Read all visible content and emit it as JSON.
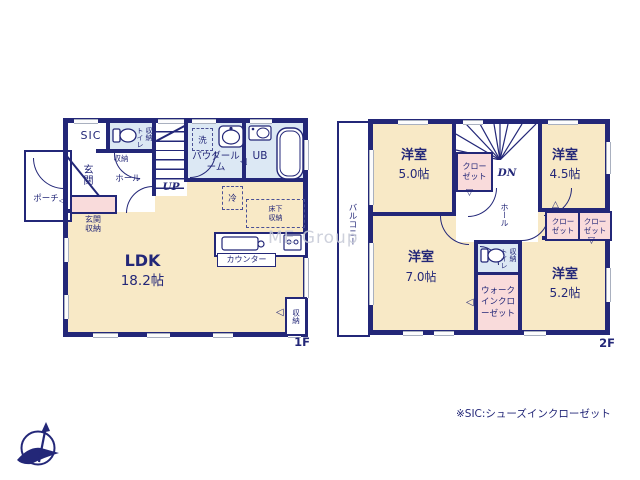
{
  "watermark": "ME Group",
  "footnote": "※SIC:シューズインクローゼット",
  "colors": {
    "wall": "#232778",
    "room_cream": "#f8e9c6",
    "room_blue": "#dce8f4",
    "room_pink": "#f9dbdb",
    "window_line": "#a9b0bf",
    "watermark": "#c6cad7"
  },
  "icons": {
    "door_left": "◁",
    "door_up": "△",
    "door_down": "▽"
  },
  "floor1": {
    "floor_label": "1F",
    "porch": "ポーチ",
    "sic": "SIC",
    "genkan": "玄関",
    "genkan_storage": "玄関収納",
    "hall": "ホール",
    "hall_storage": "収納",
    "toilet": "トイレ",
    "toilet_storage": "収納",
    "stairs_up": "UP",
    "washer": "洗",
    "powder_room": "パウダールーム",
    "bath": "UB",
    "fridge": "冷",
    "underfloor_storage": "床下収納",
    "ldk_name": "LDK",
    "ldk_size": "18.2帖",
    "counter": "カウンター",
    "ldk_storage": "収納"
  },
  "floor2": {
    "floor_label": "2F",
    "balcony": "バルコニー",
    "stairs_dn": "DN",
    "hall": "ホール",
    "closet": "クローゼット",
    "toilet": "トイレ",
    "toilet_storage": "収納",
    "wic": "ウォークインクローゼット",
    "rooms": [
      {
        "name": "洋室",
        "size": "5.0帖"
      },
      {
        "name": "洋室",
        "size": "4.5帖"
      },
      {
        "name": "洋室",
        "size": "7.0帖"
      },
      {
        "name": "洋室",
        "size": "5.2帖"
      }
    ]
  }
}
